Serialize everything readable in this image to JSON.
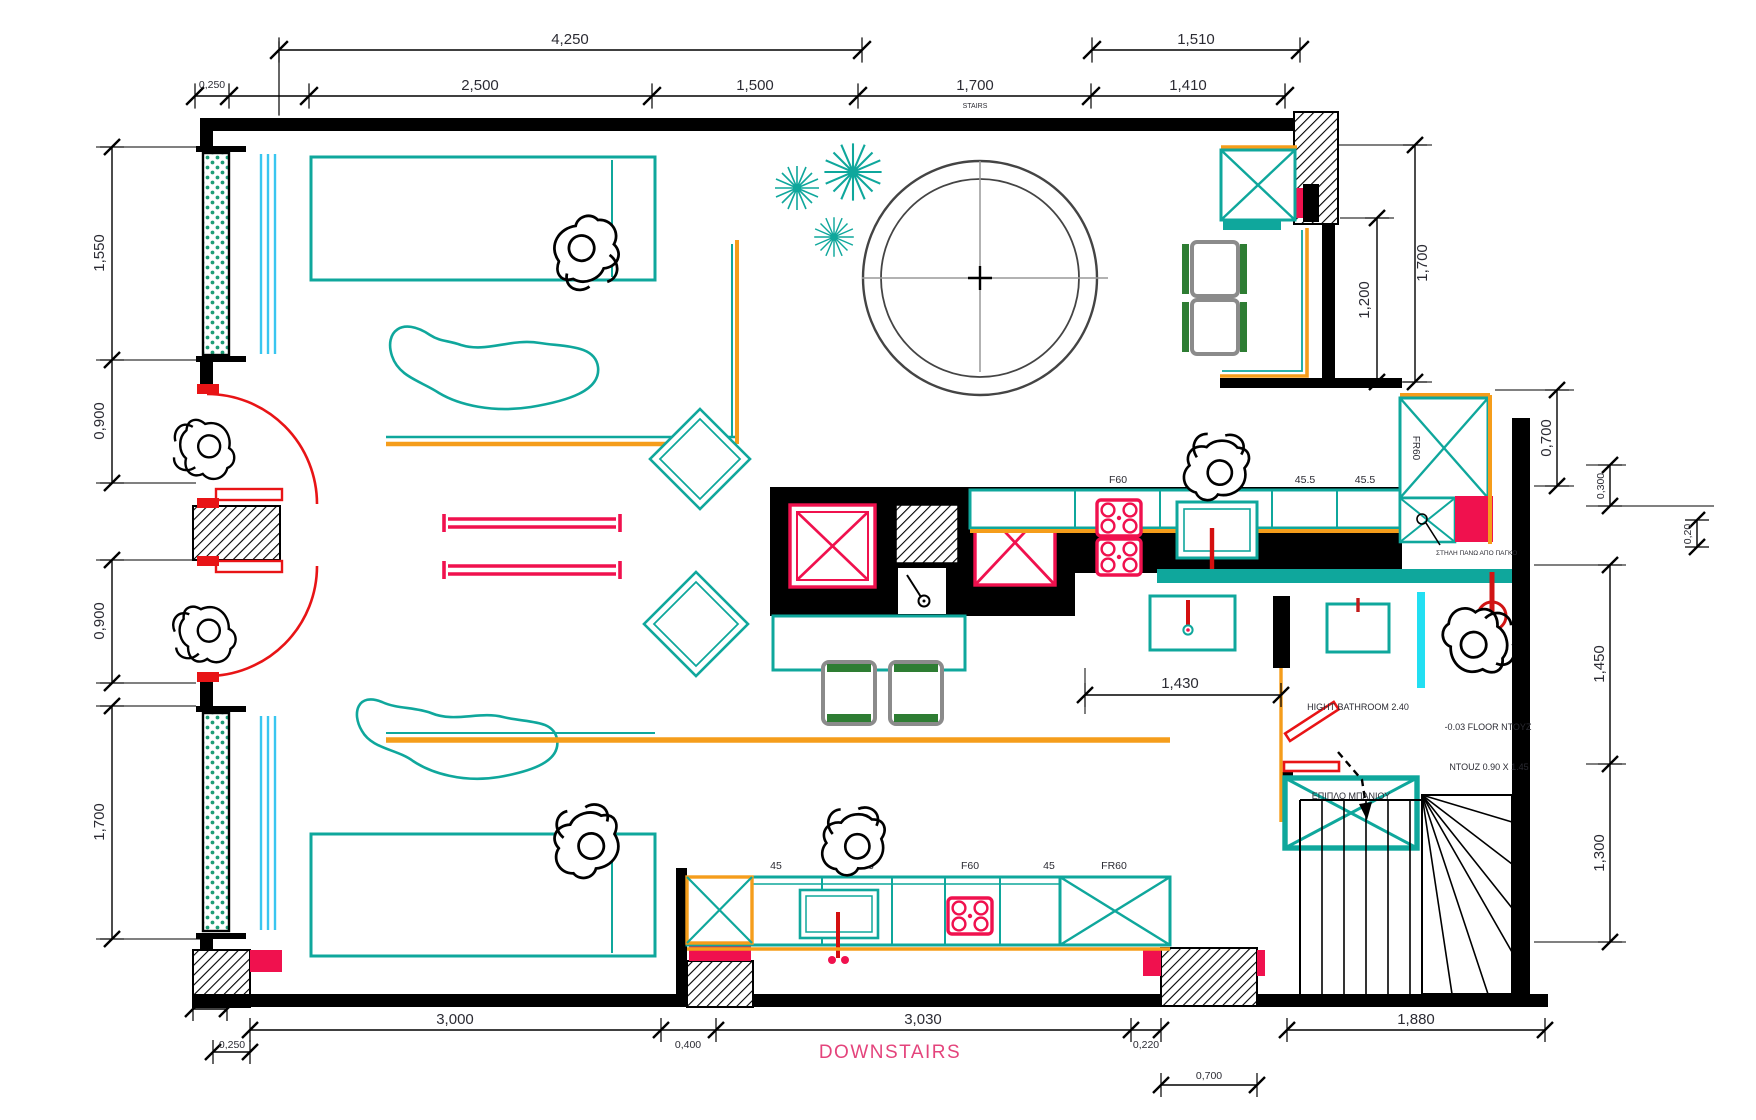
{
  "title": "DOWNSTAIRS",
  "colors": {
    "teal": "#0fa79c",
    "orange": "#f59d1b",
    "crimson": "#f0114e",
    "door_red": "#e81416",
    "curtain_cyan": "#39c6f0",
    "shower_cyan": "#22dff2",
    "window_green": "#1f9e77",
    "title_pink": "#e4447c",
    "wall": "#000000"
  },
  "dims": {
    "top1": [
      "4,250",
      "1,510"
    ],
    "top2": [
      "0,250",
      "2,500",
      "1,500",
      "1,700",
      "1,410"
    ],
    "stairs": "STAIRS",
    "left": [
      "1,550",
      "0,900",
      "0,900",
      "1,700"
    ],
    "right": [
      "1,700",
      "1,200",
      "0,700",
      "0,300",
      "0,20",
      "1,450",
      "1,300"
    ],
    "bottom": [
      "0,250",
      "3,000",
      "0,250",
      "0,400",
      "3,030",
      "0,220",
      "1,880",
      "0,700"
    ],
    "pass": "1,430"
  },
  "labels": {
    "kitchen_top": [
      "F60",
      "79",
      "45.5",
      "45.5"
    ],
    "kitchen_bottom": [
      "45",
      "86",
      "F60",
      "45",
      "FR60"
    ],
    "tall_cabinet": "FR60",
    "notes": {
      "niche": "ΔΙΑΚΟΣΜΗΤΙΚΕΣ ΕΣΟΧΕΣ",
      "column": "ΣΤΗΛΗ ΠΑΝΩ ΑΠΟ ΠΑΓΚΟ",
      "bath_height": "HIGHT BATHROOM 2.40",
      "floor": "-0.03 FLOOR NTOYZ",
      "shower_size": "NTOUZ 0.90 X 1.45",
      "bath_furniture": "ΕΠΙΠΛΟ ΜΠΑΝΙΟΥ"
    }
  }
}
